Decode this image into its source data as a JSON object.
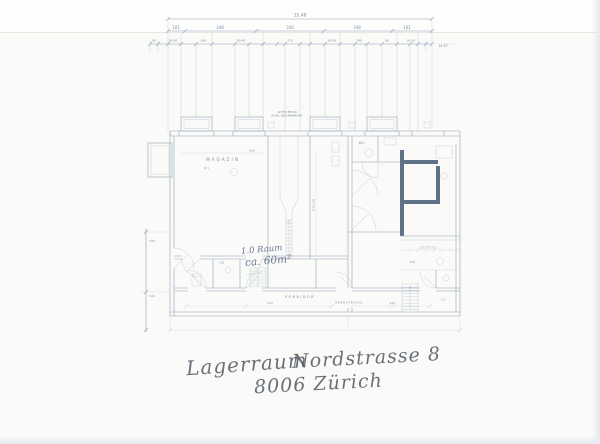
{
  "scan": {
    "handwriting": {
      "line1_left": "Lagerraum",
      "line1_right": "Nordstrasse 8",
      "line2": "8006 Zürich"
    },
    "blue_note": {
      "line1": "1.0 Raum",
      "line2": "ca. 60m²"
    },
    "plan": {
      "rooms": {
        "magazin": "MAGAZIN",
        "magazin_no": "N: 1",
        "wc": "W.C.",
        "korridor": "KORRIDOR",
        "street": "NORDSTRASSE"
      },
      "dims": {
        "total_top": "15.48",
        "major": [
          "101",
          "348",
          "340",
          "348",
          "101"
        ],
        "minor": [
          "45",
          "90 90",
          "348",
          "90 90",
          "275",
          "90 90",
          "348",
          "90",
          "90 45"
        ],
        "right_total": "14.67",
        "inner_width": "6.42",
        "shaft_note": "8.10 2.45",
        "corridor_1": "2.07",
        "corridor_2": "4.07",
        "treads": "17 17 17 17 17",
        "annex_note": "8.51",
        "room_right": "2 Z",
        "strip_note": "5.61",
        "left_v1": "4.04",
        "left_v2": "4.04"
      },
      "notes": {
        "top_line1": "GITTER BETON",
        "top_line2": "IN BVL ABSCHRANKUNG"
      }
    }
  }
}
